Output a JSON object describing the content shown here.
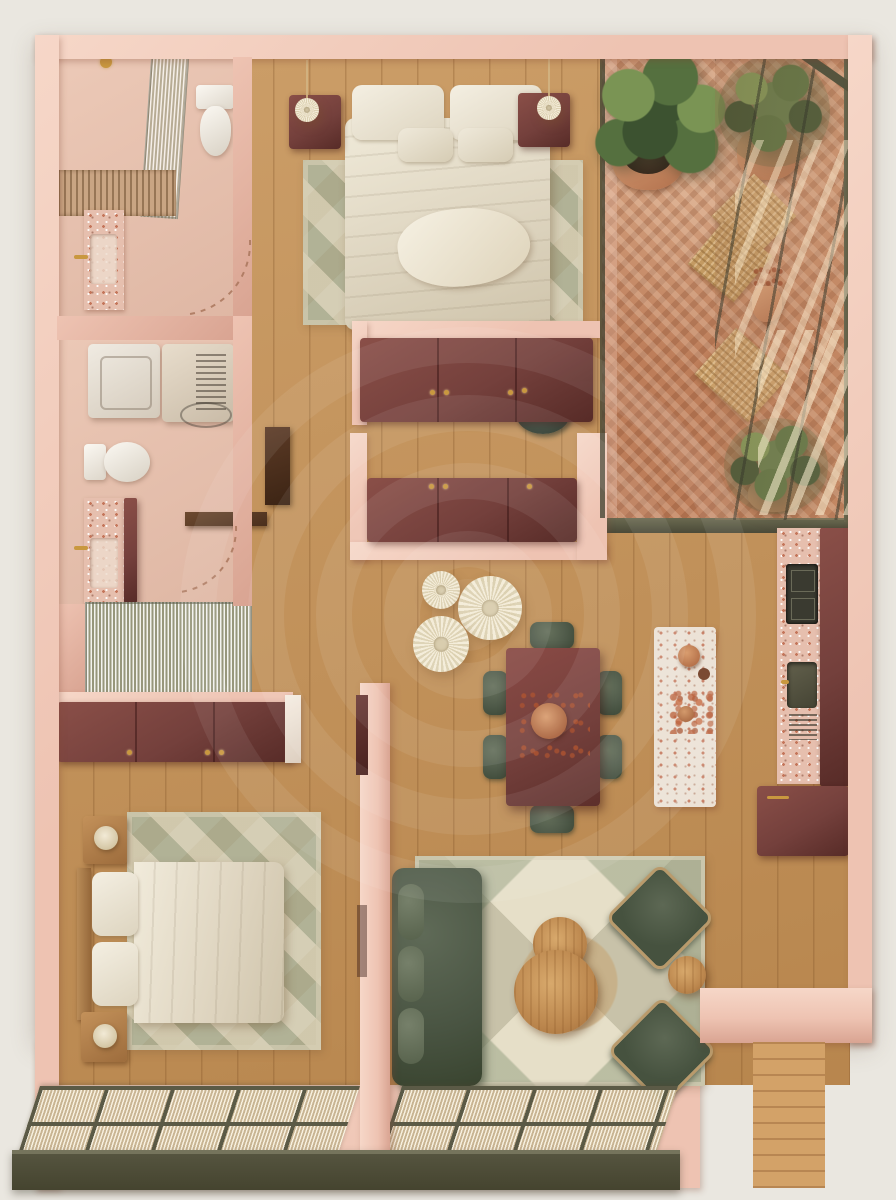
{
  "meta": {
    "description": "Top-down 3D rendered floor plan of a one-plus-bedroom apartment in blush pink, burgundy and olive green tones",
    "view": "top-down axonometric render",
    "canvas": {
      "width": 896,
      "height": 1200
    }
  },
  "palette": {
    "canvas": "#eae7e0",
    "wall-light": "#f6d7c8",
    "wall-mid": "#eec3b2",
    "wall-shadow": "#d9a492",
    "wall-deep": "#bd8371",
    "floor-wood": "#c69357",
    "plank-line": "rgba(122,77,34,0.28)",
    "maroon": "#74403c",
    "maroon-light": "#8a4f48",
    "maroon-dark": "#572b27",
    "green-sofa": "#515c4b",
    "green-dark": "#3e4a39",
    "green-light": "#66715c",
    "cream": "#efe8d6",
    "rug-base": "#c8c2a9",
    "terrazzo": "#e6bfae",
    "terrazzo-light": "#ece2d6",
    "terracotta": "#c08264",
    "brick": "#bd7d59",
    "olive": "#5b5a46",
    "olive-dark": "#4b4a38",
    "gold": "#c9983f",
    "plaster": "#ecc9b7",
    "plant": "#55703f",
    "plant-dark": "#3c5230",
    "plant-light": "#7a9454",
    "deck": "#d3a268"
  },
  "watermark": {
    "style": "concentric-rings logo",
    "color": "#ffffff"
  },
  "rooms": [
    {
      "id": "bathroom-1",
      "label": "Bathroom",
      "items": [
        "walk-in shower with fluted glass screen",
        "slatted shower tray",
        "shower head",
        "toilet",
        "pink terrazzo vanity",
        "brass faucet",
        "door swing arc"
      ]
    },
    {
      "id": "bedroom-1",
      "label": "Main Bedroom",
      "items": [
        "double bed with cream duvet",
        "four pillows",
        "throw blanket",
        "two burgundy nightstands",
        "two pendant lamps",
        "geometric triangle rug"
      ]
    },
    {
      "id": "balcony",
      "label": "Balcony Terrace",
      "items": [
        "herringbone terracotta brick floor",
        "fiddle-leaf fig in terracotta pot",
        "potted palm (upper)",
        "potted palm (lower)",
        "two woven floor cushions",
        "woven mat",
        "terracotta vase with dried stems",
        "black-framed window wall",
        "sunlight streaks"
      ]
    },
    {
      "id": "laundry-bath",
      "label": "Laundry + WC",
      "items": [
        "washing machine",
        "vented laundry unit",
        "toilet",
        "pink terrazzo vanity",
        "brass faucet",
        "dark wood shelf",
        "open dark door leaf",
        "fluted glass shower wall",
        "door swing arc"
      ]
    },
    {
      "id": "storage",
      "label": "Central Storage",
      "items": [
        "burgundy three-door wardrobe (upper)",
        "burgundy three-door sideboard (lower)",
        "dark green stool",
        "blush partition walls"
      ]
    },
    {
      "id": "dining",
      "label": "Dining Area",
      "items": [
        "burgundy rectangular dining table",
        "six dark green chairs",
        "three pleated paper pendant lights",
        "terracotta dried-flower centerpiece",
        "pink terrazzo island with bowls and dried flowers"
      ]
    },
    {
      "id": "kitchen",
      "label": "Kitchen Run",
      "items": [
        "terrazzo countertop",
        "dark gas hob",
        "inset sink",
        "drying rack",
        "burgundy cabinet front",
        "burgundy base cabinet with brass pull"
      ]
    },
    {
      "id": "bedroom-2",
      "label": "Second Bedroom",
      "items": [
        "double bed with wood headboard",
        "cream duvet",
        "two wood nightstands with lamps",
        "burgundy overhead cabinets",
        "geometric rug"
      ]
    },
    {
      "id": "living",
      "label": "Living Room",
      "items": [
        "dark green velvet sofa with bolster cushions",
        "two round wood coffee tables",
        "two dark green armchairs",
        "round wood side table",
        "geometric star rug",
        "blush partition wall with open door"
      ]
    },
    {
      "id": "entry",
      "label": "Entry Nook",
      "items": [
        "wood plank deck",
        "blush L-shaped wall"
      ]
    },
    {
      "id": "facade",
      "label": "South Window Facade",
      "items": [
        "fluted glass panel grid",
        "olive steel frames and sill"
      ]
    }
  ]
}
